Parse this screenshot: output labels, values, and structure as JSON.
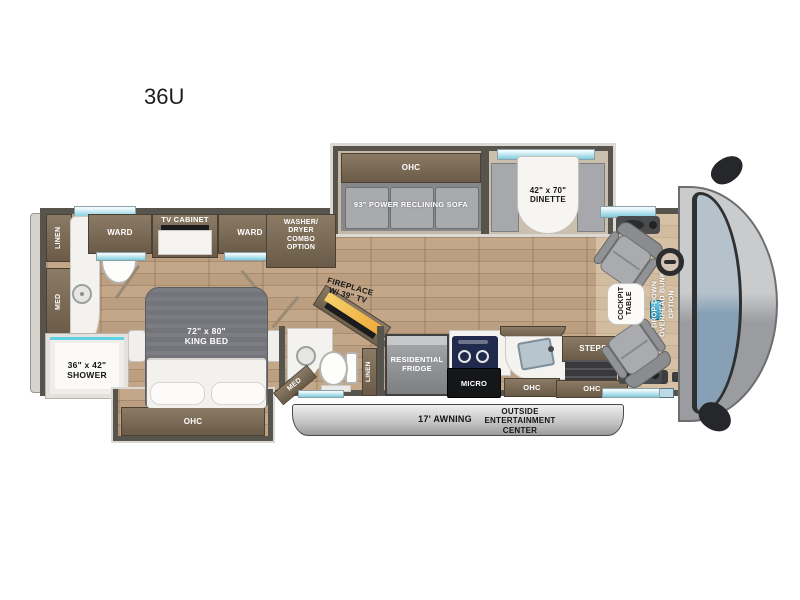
{
  "title": "36U",
  "colors": {
    "wood": "#b89c7e",
    "cabinet_brown": "#7b6b56",
    "wall": "#57534d",
    "window_accent": "#7fccdd",
    "sofa_gray": "#a9abae",
    "bed_gray": "#74757a",
    "fireplace_yellow": "#f2c14e",
    "cap_gray": "#b0b2b4",
    "windshield_blue": "#87a0b5"
  },
  "labels": {
    "ohc": "OHC",
    "linen": "LINEN",
    "med": "MED",
    "shower": "36\" x 42\"\nSHOWER",
    "ward": "WARD",
    "tv_cabinet": "TV CABINET",
    "washer_dryer": "WASHER/\nDRYER\nCOMBO\nOPTION",
    "king_bed": "72\" x 80\"\nKING BED",
    "sofa": "93\" POWER RECLINING SOFA",
    "dinette": "42\" x 70\"\nDINETTE",
    "fireplace": "FIREPLACE\nW/ 39\" TV",
    "fridge": "RESIDENTIAL\nFRIDGE",
    "micro": "MICRO",
    "steps": "STEPS",
    "cockpit_table": "COCKPIT\nTABLE",
    "overhead_bunk": "DROP-DOWN\nOVERHEAD BUNK\nOPTION",
    "awning": "17' AWNING",
    "outside_entertainment": "OUTSIDE\nENTERTAINMENT\nCENTER"
  }
}
